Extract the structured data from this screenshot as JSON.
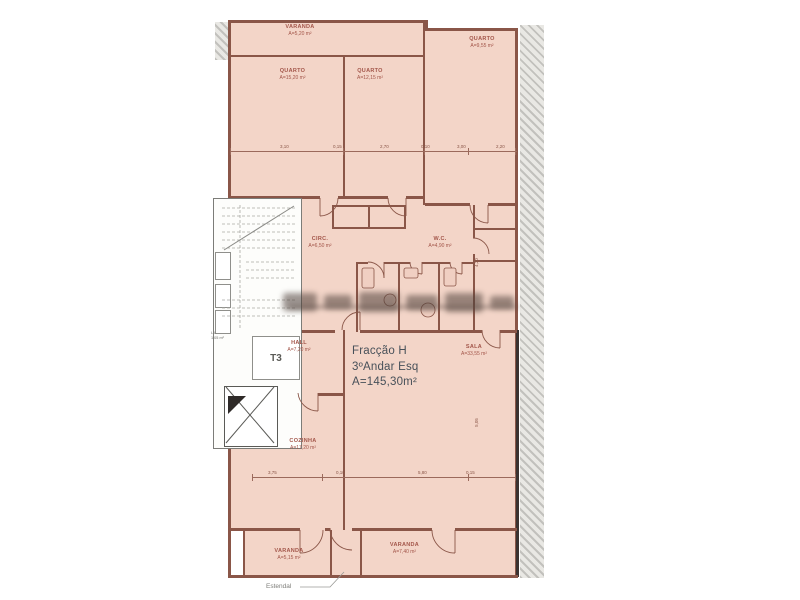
{
  "plan": {
    "unit": {
      "fraction": "Fracção H",
      "floor": "3ºAndar Esq",
      "area": "A=145,30m²",
      "typology": "T3"
    },
    "rooms": [
      {
        "id": "varanda-top",
        "name": "VARANDA",
        "area": "A=5,20 m²"
      },
      {
        "id": "quarto-1",
        "name": "QUARTO",
        "area": "A=15,20 m²"
      },
      {
        "id": "quarto-2",
        "name": "QUARTO",
        "area": "A=12,15 m²"
      },
      {
        "id": "quarto-3",
        "name": "QUARTO",
        "area": "A=9,55 m²"
      },
      {
        "id": "circ",
        "name": "CIRC.",
        "area": "A=6,50 m²"
      },
      {
        "id": "wc",
        "name": "W.C.",
        "area": "A=4,90 m²"
      },
      {
        "id": "hall",
        "name": "HALL",
        "area": "A=7,20 m²"
      },
      {
        "id": "sala",
        "name": "SALA",
        "area": "A=33,55 m²"
      },
      {
        "id": "cozinha",
        "name": "COZINHA",
        "area": "A=17,20 m²"
      },
      {
        "id": "varanda-bl",
        "name": "VARANDA",
        "area": "A=5,15 m²"
      },
      {
        "id": "varanda-br",
        "name": "VARANDA",
        "area": "A=7,40 m²"
      }
    ],
    "annotations": {
      "estendal": "Estendal",
      "duct_abbr": "L.L.",
      "duct_area": "1,05 m²"
    },
    "dimensions": {
      "top": [
        "3,10",
        "0,15",
        "2,70",
        "0,10",
        "3,00",
        "2,20"
      ],
      "bottom": [
        "3,75",
        "0,10",
        "5,80",
        "0,15"
      ],
      "right": [
        "4,20",
        "5,05"
      ]
    },
    "colors": {
      "fill": "#f3d5c8",
      "wall": "#8a5648",
      "label_text": "#a3564a",
      "unit_text": "#475059"
    }
  }
}
